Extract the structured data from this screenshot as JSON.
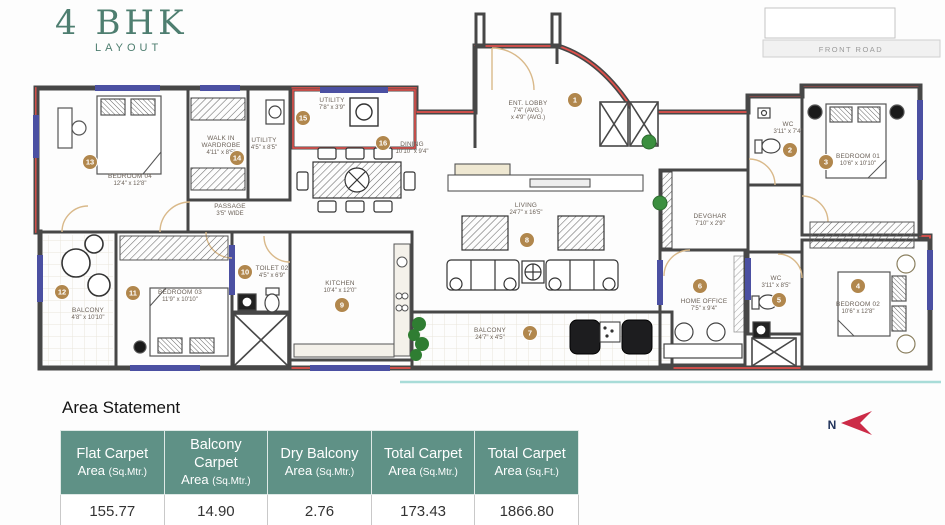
{
  "title": {
    "main": "4 BHK",
    "sub": "LAYOUT"
  },
  "front_road_label": "FRONT ROAD",
  "north": {
    "label": "N"
  },
  "rooms": [
    {
      "id": "ent-lobby",
      "number": "1",
      "name": "ENT. LOBBY",
      "dims": "7'4\" (AVG.) x 4'9\" (AVG.)"
    },
    {
      "id": "wc-01",
      "number": "2",
      "name": "WC",
      "dims": "3'11\" x 7'4\""
    },
    {
      "id": "bedroom-01",
      "number": "3",
      "name": "BEDROOM 01",
      "dims": "10'6\" x 10'10\""
    },
    {
      "id": "bedroom-02",
      "number": "4",
      "name": "BEDROOM 02",
      "dims": "10'6\" x 12'8\""
    },
    {
      "id": "wc-02",
      "number": "5",
      "name": "WC",
      "dims": "3'11\" x 8'5\""
    },
    {
      "id": "home-office",
      "number": "6",
      "name": "HOME OFFICE",
      "dims": "7'5\" x 9'4\""
    },
    {
      "id": "balcony",
      "number": "7",
      "name": "BALCONY",
      "dims": "24'7\" x 4'5\""
    },
    {
      "id": "living",
      "number": "8",
      "name": "LIVING",
      "dims": "24'7\" x 16'5\""
    },
    {
      "id": "kitchen",
      "number": "9",
      "name": "KITCHEN",
      "dims": "10'4\" x 12'0\""
    },
    {
      "id": "toilet-02",
      "number": "10",
      "name": "TOILET 02",
      "dims": "4'5\" x 6'9\""
    },
    {
      "id": "bedroom-03",
      "number": "11",
      "name": "BEDROOM 03",
      "dims": "11'9\" x 10'10\""
    },
    {
      "id": "balcony-02",
      "number": "12",
      "name": "BALCONY",
      "dims": "4'8\" x 10'10\""
    },
    {
      "id": "bedroom-04",
      "number": "13",
      "name": "BEDROOM 04",
      "dims": "12'4\" x 12'8\""
    },
    {
      "id": "walk-in-wardrobe",
      "number": "14",
      "name": "WALK IN WARDROBE",
      "dims": "4'11\" x 8'5\""
    },
    {
      "id": "utility",
      "number": "15",
      "name": "UTILITY",
      "dims": "7'8\" x 3'9\""
    },
    {
      "id": "dining",
      "number": "16",
      "name": "DINING",
      "dims": "10'10\" x 9'4\""
    }
  ],
  "plan_labels": [
    {
      "id": "passage",
      "name": "PASSAGE",
      "dims": "3'5\" WIDE"
    },
    {
      "id": "devghar",
      "name": "DEVGHAR",
      "dims": "7'10\" x 2'9\""
    },
    {
      "id": "utility-02",
      "name": "UTILITY",
      "dims": "4'5\" x 8'5\""
    }
  ],
  "area_statement": {
    "title": "Area Statement",
    "columns": [
      {
        "line1": "Flat Carpet",
        "line2": "Area",
        "unit": "(Sq.Mtr.)"
      },
      {
        "line1": "Balcony Carpet",
        "line2": "Area",
        "unit": "(Sq.Mtr.)"
      },
      {
        "line1": "Dry Balcony",
        "line2": "Area",
        "unit": "(Sq.Mtr.)"
      },
      {
        "line1": "Total Carpet",
        "line2": "Area",
        "unit": "(Sq.Mtr.)"
      },
      {
        "line1": "Total Carpet",
        "line2": "Area",
        "unit": "(Sq.Ft.)"
      }
    ],
    "values": [
      "155.77",
      "14.90",
      "2.76",
      "173.43",
      "1866.80"
    ]
  },
  "colors": {
    "table_header_teal": "#5f9186",
    "title_green": "#4e7e70",
    "exterior_wall_red": "#e0504b",
    "window_navy": "#4b50a2",
    "wall_dark": "#474747",
    "marker_gold": "#b1874d",
    "north_arrow_red": "#cc2b47",
    "door_beige": "#d9b98a",
    "plant_green": "#3b8f3f"
  }
}
